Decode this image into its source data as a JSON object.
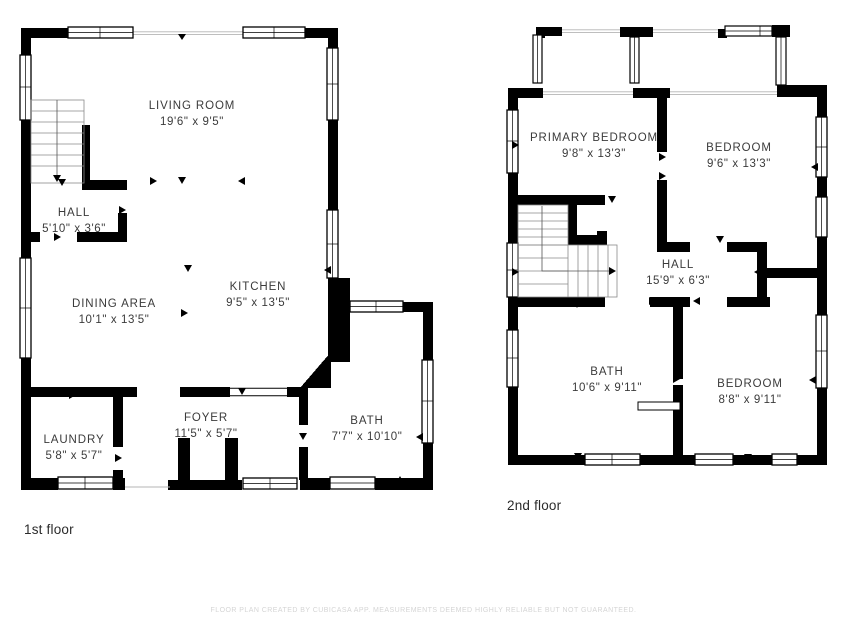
{
  "floors": [
    {
      "label": "1st floor",
      "rooms": [
        {
          "name": "LIVING ROOM",
          "dims": "19'6\" x 9'5\""
        },
        {
          "name": "HALL",
          "dims": "5'10\" x 3'6\""
        },
        {
          "name": "DINING AREA",
          "dims": "10'1\" x 13'5\""
        },
        {
          "name": "KITCHEN",
          "dims": "9'5\" x 13'5\""
        },
        {
          "name": "LAUNDRY",
          "dims": "5'8\" x 5'7\""
        },
        {
          "name": "FOYER",
          "dims": "11'5\" x 5'7\""
        },
        {
          "name": "BATH",
          "dims": "7'7\" x 10'10\""
        }
      ]
    },
    {
      "label": "2nd floor",
      "rooms": [
        {
          "name": "PRIMARY BEDROOM",
          "dims": "9'8\" x 13'3\""
        },
        {
          "name": "BEDROOM",
          "dims": "9'6\" x 13'3\""
        },
        {
          "name": "HALL",
          "dims": "15'9\" x 6'3\""
        },
        {
          "name": "BATH",
          "dims": "10'6\" x 9'11\""
        },
        {
          "name": "BEDROOM",
          "dims": "8'8\" x 9'11\""
        }
      ]
    }
  ],
  "footer": "FLOOR PLAN CREATED BY CUBICASA APP. MEASUREMENTS DEEMED HIGHLY RELIABLE BUT NOT GUARANTEED.",
  "colors": {
    "wall": "#000000",
    "room_text": "#3b3b3b",
    "floor_label_text": "#2b2b2b",
    "footer_text": "#d5d5d5",
    "thin_line": "#b5b5b5"
  }
}
